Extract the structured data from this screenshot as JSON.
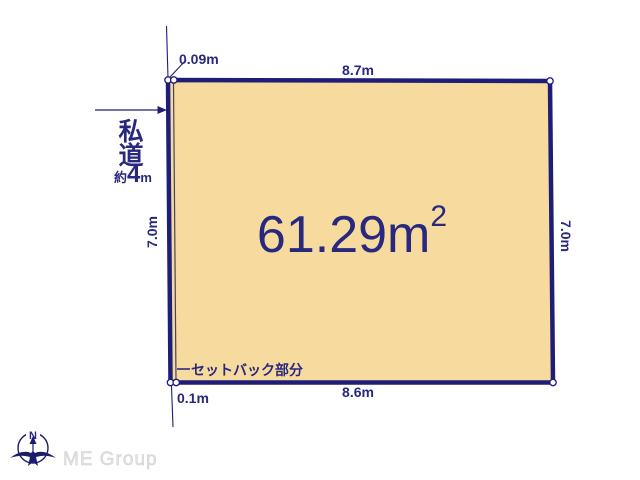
{
  "plot": {
    "area_value": "61.29m",
    "area_exponent": "2",
    "edges": {
      "top": "8.7m",
      "bottom": "8.6m",
      "left": "7.0m",
      "right": "7.0m"
    },
    "setback": {
      "label": "セットバック部分",
      "top_offset": "0.09m",
      "bottom_offset": "0.1m"
    }
  },
  "road": {
    "name_line1": "私",
    "name_line2": "道",
    "width_prefix": "約",
    "width_value": "4",
    "width_unit": "m"
  },
  "compass": {
    "north": "N"
  },
  "watermark": {
    "text": "ME Group"
  },
  "colors": {
    "plot_fill": "#f7da9d",
    "line_navy": "#1e1e78",
    "text_navy": "#28287e",
    "setback_line": "#44445f",
    "watermark_gray": "#e2e2e2"
  }
}
